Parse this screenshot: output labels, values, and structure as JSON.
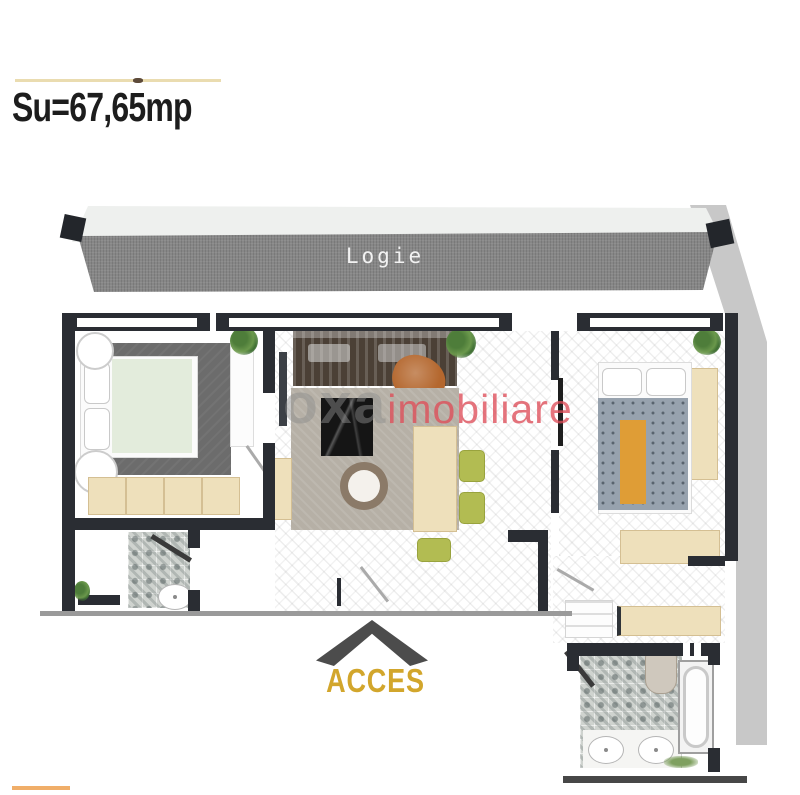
{
  "header": {
    "surface_label": "Su=67,65mp"
  },
  "plan": {
    "loggia_label": "Logie",
    "access_label": "ACCES"
  },
  "watermark": {
    "part1": "oxa",
    "part2": "imobiliare"
  },
  "colors": {
    "wall_dark": "#2a2d33",
    "loggia_floor_gray": "#878787",
    "side_band_gray": "#c8c8c8",
    "accent_gold": "#d2a62c",
    "watermark_red": "#de4d58",
    "watermark_gray": "#8c8c8c",
    "furniture_beige": "#eee0bb",
    "chair_olive": "#b2bc52",
    "bed_runner_orange": "#df9d36",
    "bedroom_rug_gray": "#6c6c6c",
    "top_line_yellow": "#eadcb0"
  }
}
